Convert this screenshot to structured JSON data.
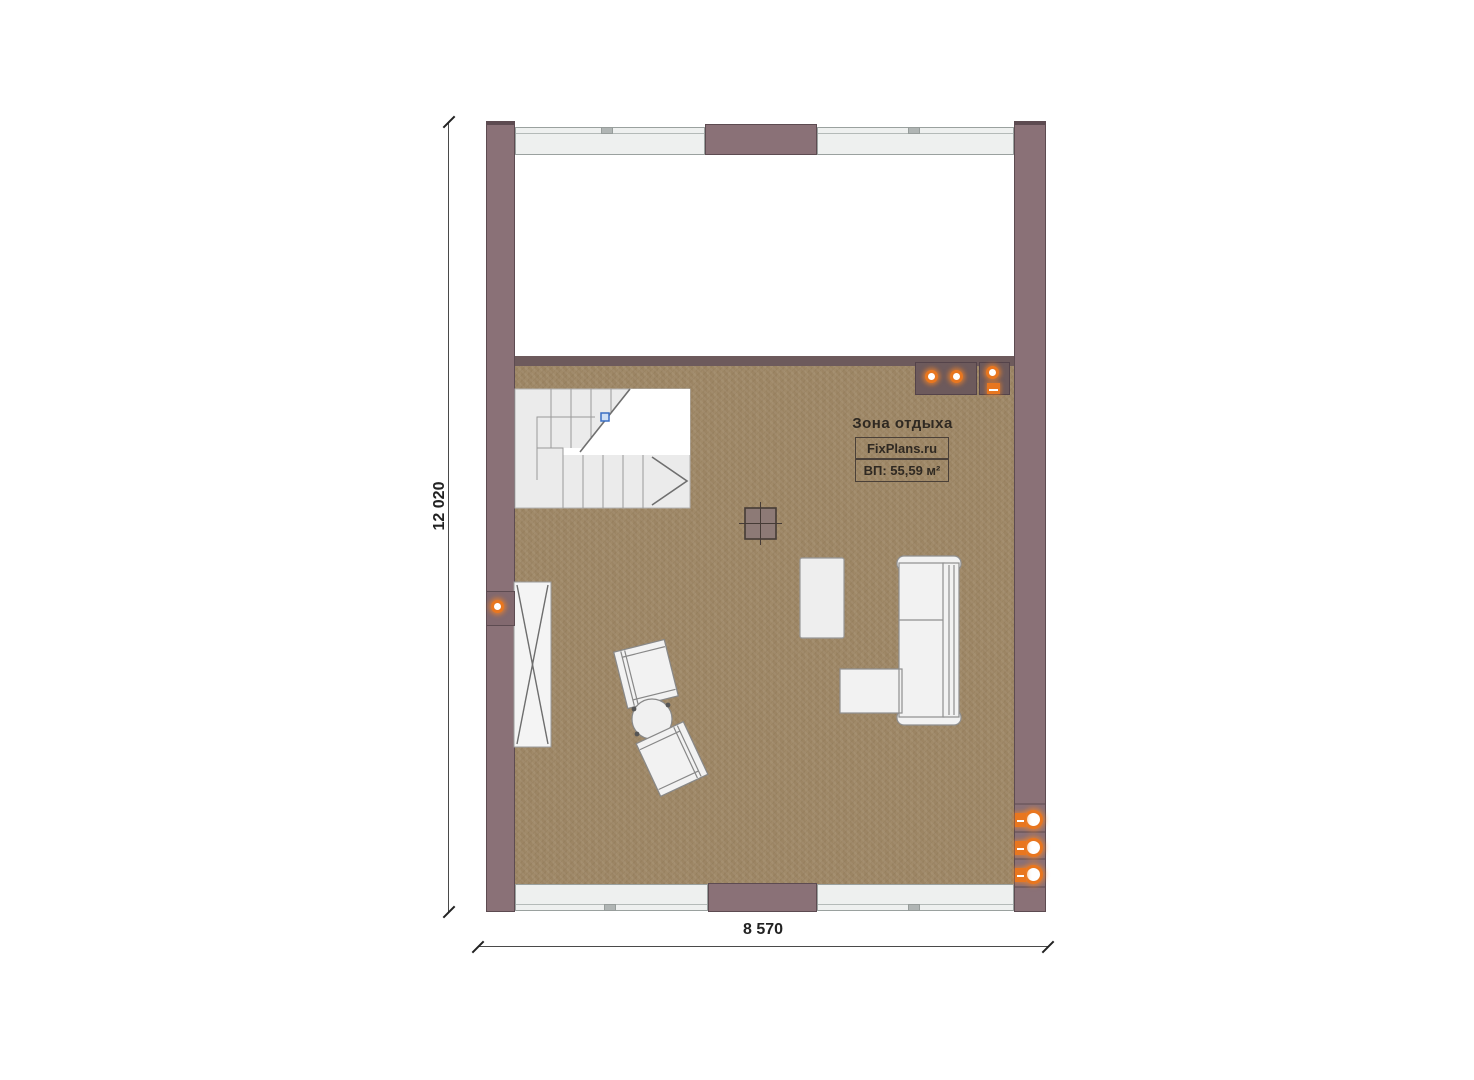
{
  "room": {
    "title": "Зона отдыха",
    "brand": "FixPlans.ru",
    "area": "ВП: 55,59 м²"
  },
  "dimensions": {
    "height_label": "12 020",
    "width_label": "8 570"
  },
  "icons": {
    "spotlight": "orange-ring-circle",
    "socket": "orange-square-with-circle",
    "wall_light": "orange-ring-circle",
    "stair_direction": "chevron-right",
    "stair_break_marker": "blue-square"
  },
  "colors": {
    "wall": "#8a7177",
    "wall-dark": "#6d5a5c",
    "wall-border": "#5d4b51",
    "floor": "#9c8564",
    "window-fill": "#eef0ef",
    "accent-orange": "#e8761f",
    "dim-line": "#4a4a4a",
    "text-dark": "#2f2922"
  }
}
